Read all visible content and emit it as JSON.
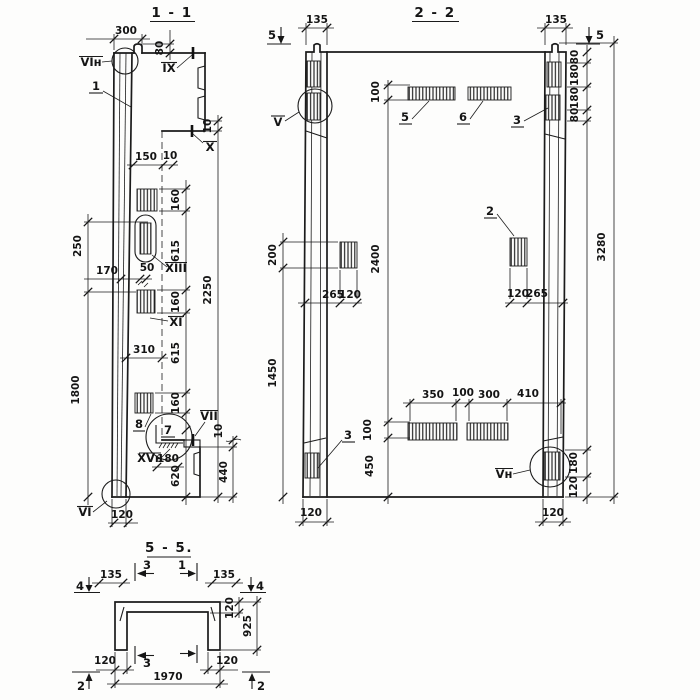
{
  "colors": {
    "paper": "#fdfdfc",
    "ink": "#1b1b1b"
  },
  "s11": {
    "title": "1 - 1",
    "dims": {
      "top_width": "300",
      "tongue_height": "80",
      "top_step": "10",
      "offset_150": "150",
      "gap_10": "10",
      "spacing": [
        "160",
        "615",
        "160",
        "615",
        "160"
      ],
      "loop_length": "250",
      "loop_offset": "170",
      "loop_width": "50",
      "mid_310": "310",
      "total_height": "2250",
      "left_height": "1800",
      "plate_width": "180",
      "bottom_620": "620",
      "bottom_440": "440",
      "plate_step": "10",
      "wall_width": "120"
    },
    "callouts": {
      "vi_n": "VIн",
      "item1": "1",
      "ix": "IX",
      "x": "X",
      "xiii": "XIII",
      "xi": "XI",
      "item8": "8",
      "item7": "7",
      "vii": "VII",
      "xv_n": "XVн",
      "vi": "VI"
    }
  },
  "s22": {
    "title": "2 - 2",
    "dims": {
      "rib_left": "135",
      "rib_right": "135",
      "top_bar_height": "100",
      "right_top": [
        "80",
        "180",
        "180",
        "80"
      ],
      "left_offset": "200",
      "left_height": "1450",
      "mid_height": "2400",
      "total_height": "3280",
      "sq_left": [
        "265",
        "120"
      ],
      "sq_right": [
        "120",
        "265"
      ],
      "bottom_row": [
        "350",
        "100",
        "300",
        "410"
      ],
      "bottom_bar_height": "100",
      "bottom_offset": "450",
      "right_bottom": [
        "180",
        "120"
      ],
      "foot_left": "120",
      "foot_right": "120"
    },
    "callouts": {
      "v": "V",
      "item5": "5",
      "item6": "6",
      "item3_top": "3",
      "item2": "2",
      "item3_bottom": "3",
      "v_n": "Vн"
    },
    "marks": {
      "cut5_left": "5",
      "cut5_right": "5"
    }
  },
  "s55": {
    "title": "5 - 5.",
    "dims": {
      "edge_left": "135",
      "edge_right": "135",
      "thickness": "120",
      "height": "925",
      "leg_left": "120",
      "leg_right": "120",
      "width": "1970"
    },
    "marks": {
      "cut4_left": "4",
      "cut4_right": "4",
      "cut3_top": "3",
      "cut1_top": "1",
      "cut3_bottom": "3",
      "cut2_left": "2",
      "cut2_right": "2"
    }
  }
}
